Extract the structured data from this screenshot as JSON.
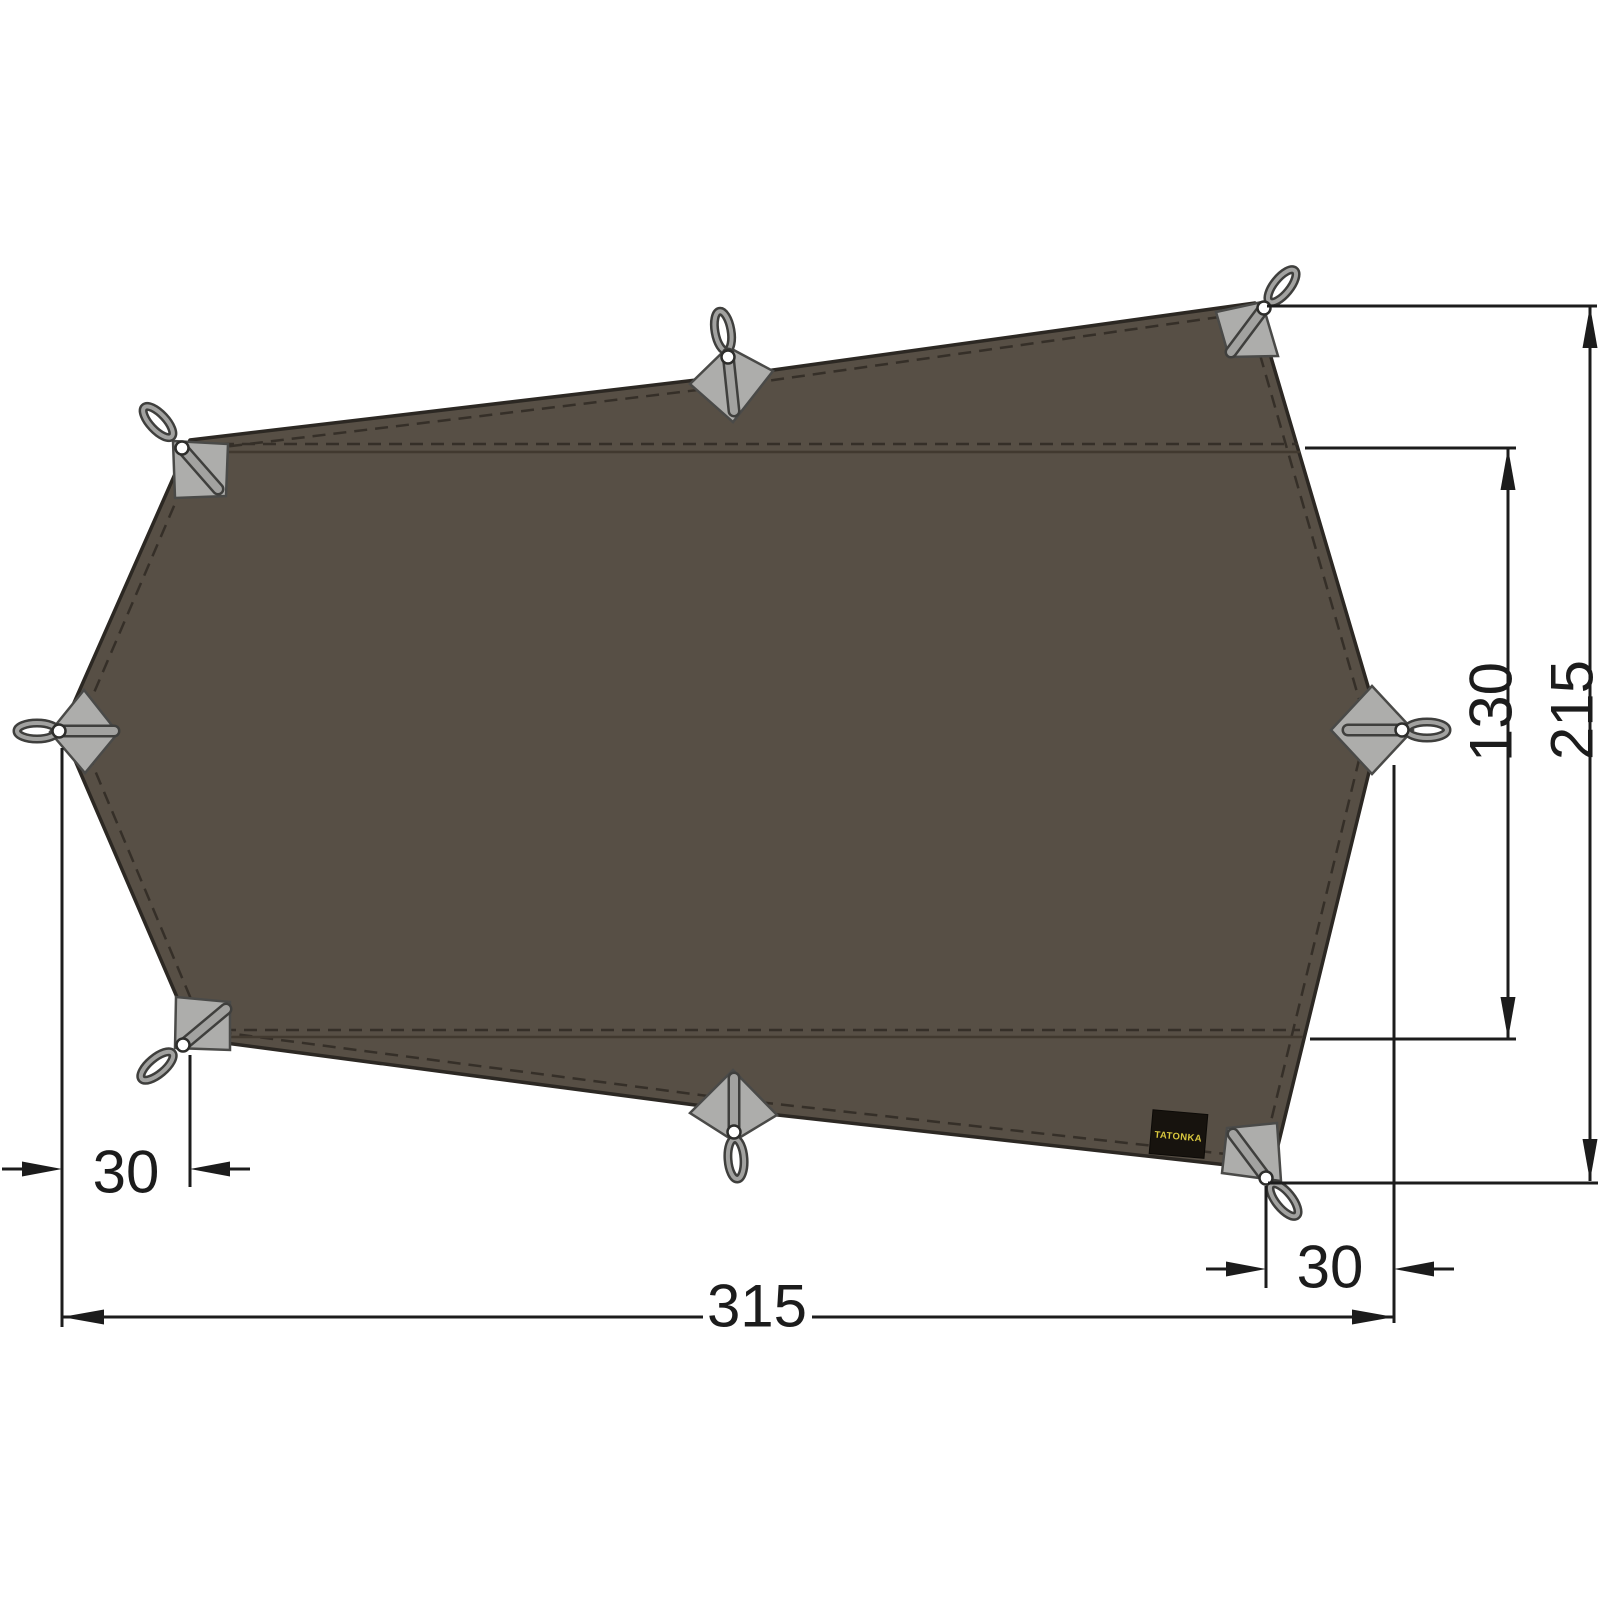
{
  "diagram": {
    "kind": "product-dimension-drawing",
    "subject": "tarp top view with guy-line attachment points",
    "units_implied": "cm"
  },
  "brand": {
    "label": "TATONKA",
    "label_bg": "#17130e",
    "label_text_color": "#d9c83e"
  },
  "dimensions": {
    "width": {
      "value": "315",
      "orientation": "horizontal",
      "position": "bottom"
    },
    "height": {
      "value": "215",
      "orientation": "vertical",
      "position": "right-outer"
    },
    "middle_panel": {
      "value": "130",
      "orientation": "vertical",
      "position": "right-inner"
    },
    "left_offset": {
      "value": "30",
      "orientation": "horizontal",
      "position": "bottom-left"
    },
    "right_offset": {
      "value": "30",
      "orientation": "horizontal",
      "position": "bottom-right"
    }
  },
  "tarp": {
    "fabric_color": "#574f45",
    "outline_color": "#2c2823",
    "seam_color": "#352f28",
    "patch_color": "#adadab",
    "strap_color": "#a2a2a0",
    "attachment_points": 8,
    "horizontal_seams": 2
  },
  "dimension_style": {
    "line_color": "#1c1c1c",
    "text_color": "#1c1c1c"
  }
}
